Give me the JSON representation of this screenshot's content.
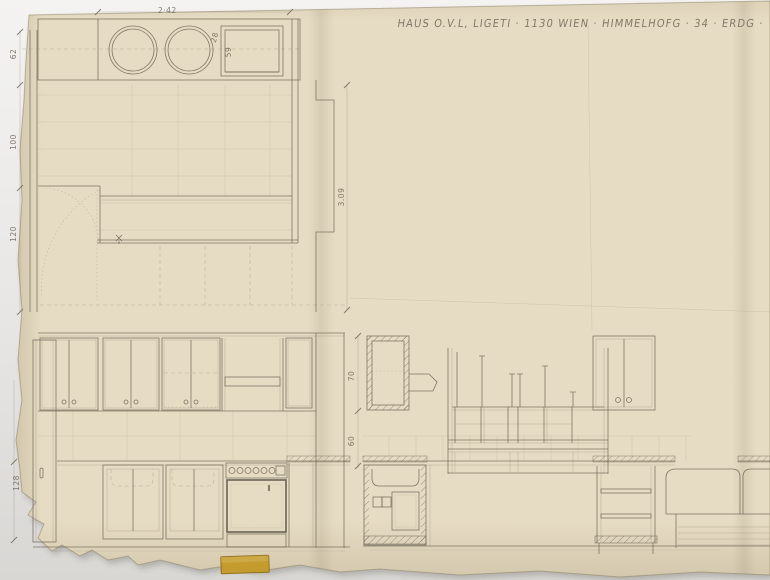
{
  "sheet": {
    "title": "HAUS O.V.L, LIGETI · 1130 WIEN · HIMMELHOFG · 34 · ERDG ·"
  },
  "plan": {
    "dims": {
      "counter_length": "2·42",
      "burner_offset": "28",
      "sink_width": "59",
      "wall_top": "62",
      "wall_mid": "100",
      "wall_low": "120",
      "room_depth": "3.09"
    }
  },
  "elevation_left": {
    "dims": {
      "base_height": "128"
    }
  },
  "elevation_right": {
    "dims": {
      "upper": "70",
      "lower": "60"
    }
  },
  "colors": {
    "paper": "#e6dcc3",
    "ink": "#6c6456",
    "tape": "#c49a27",
    "backdrop": "#e4e3e1"
  }
}
